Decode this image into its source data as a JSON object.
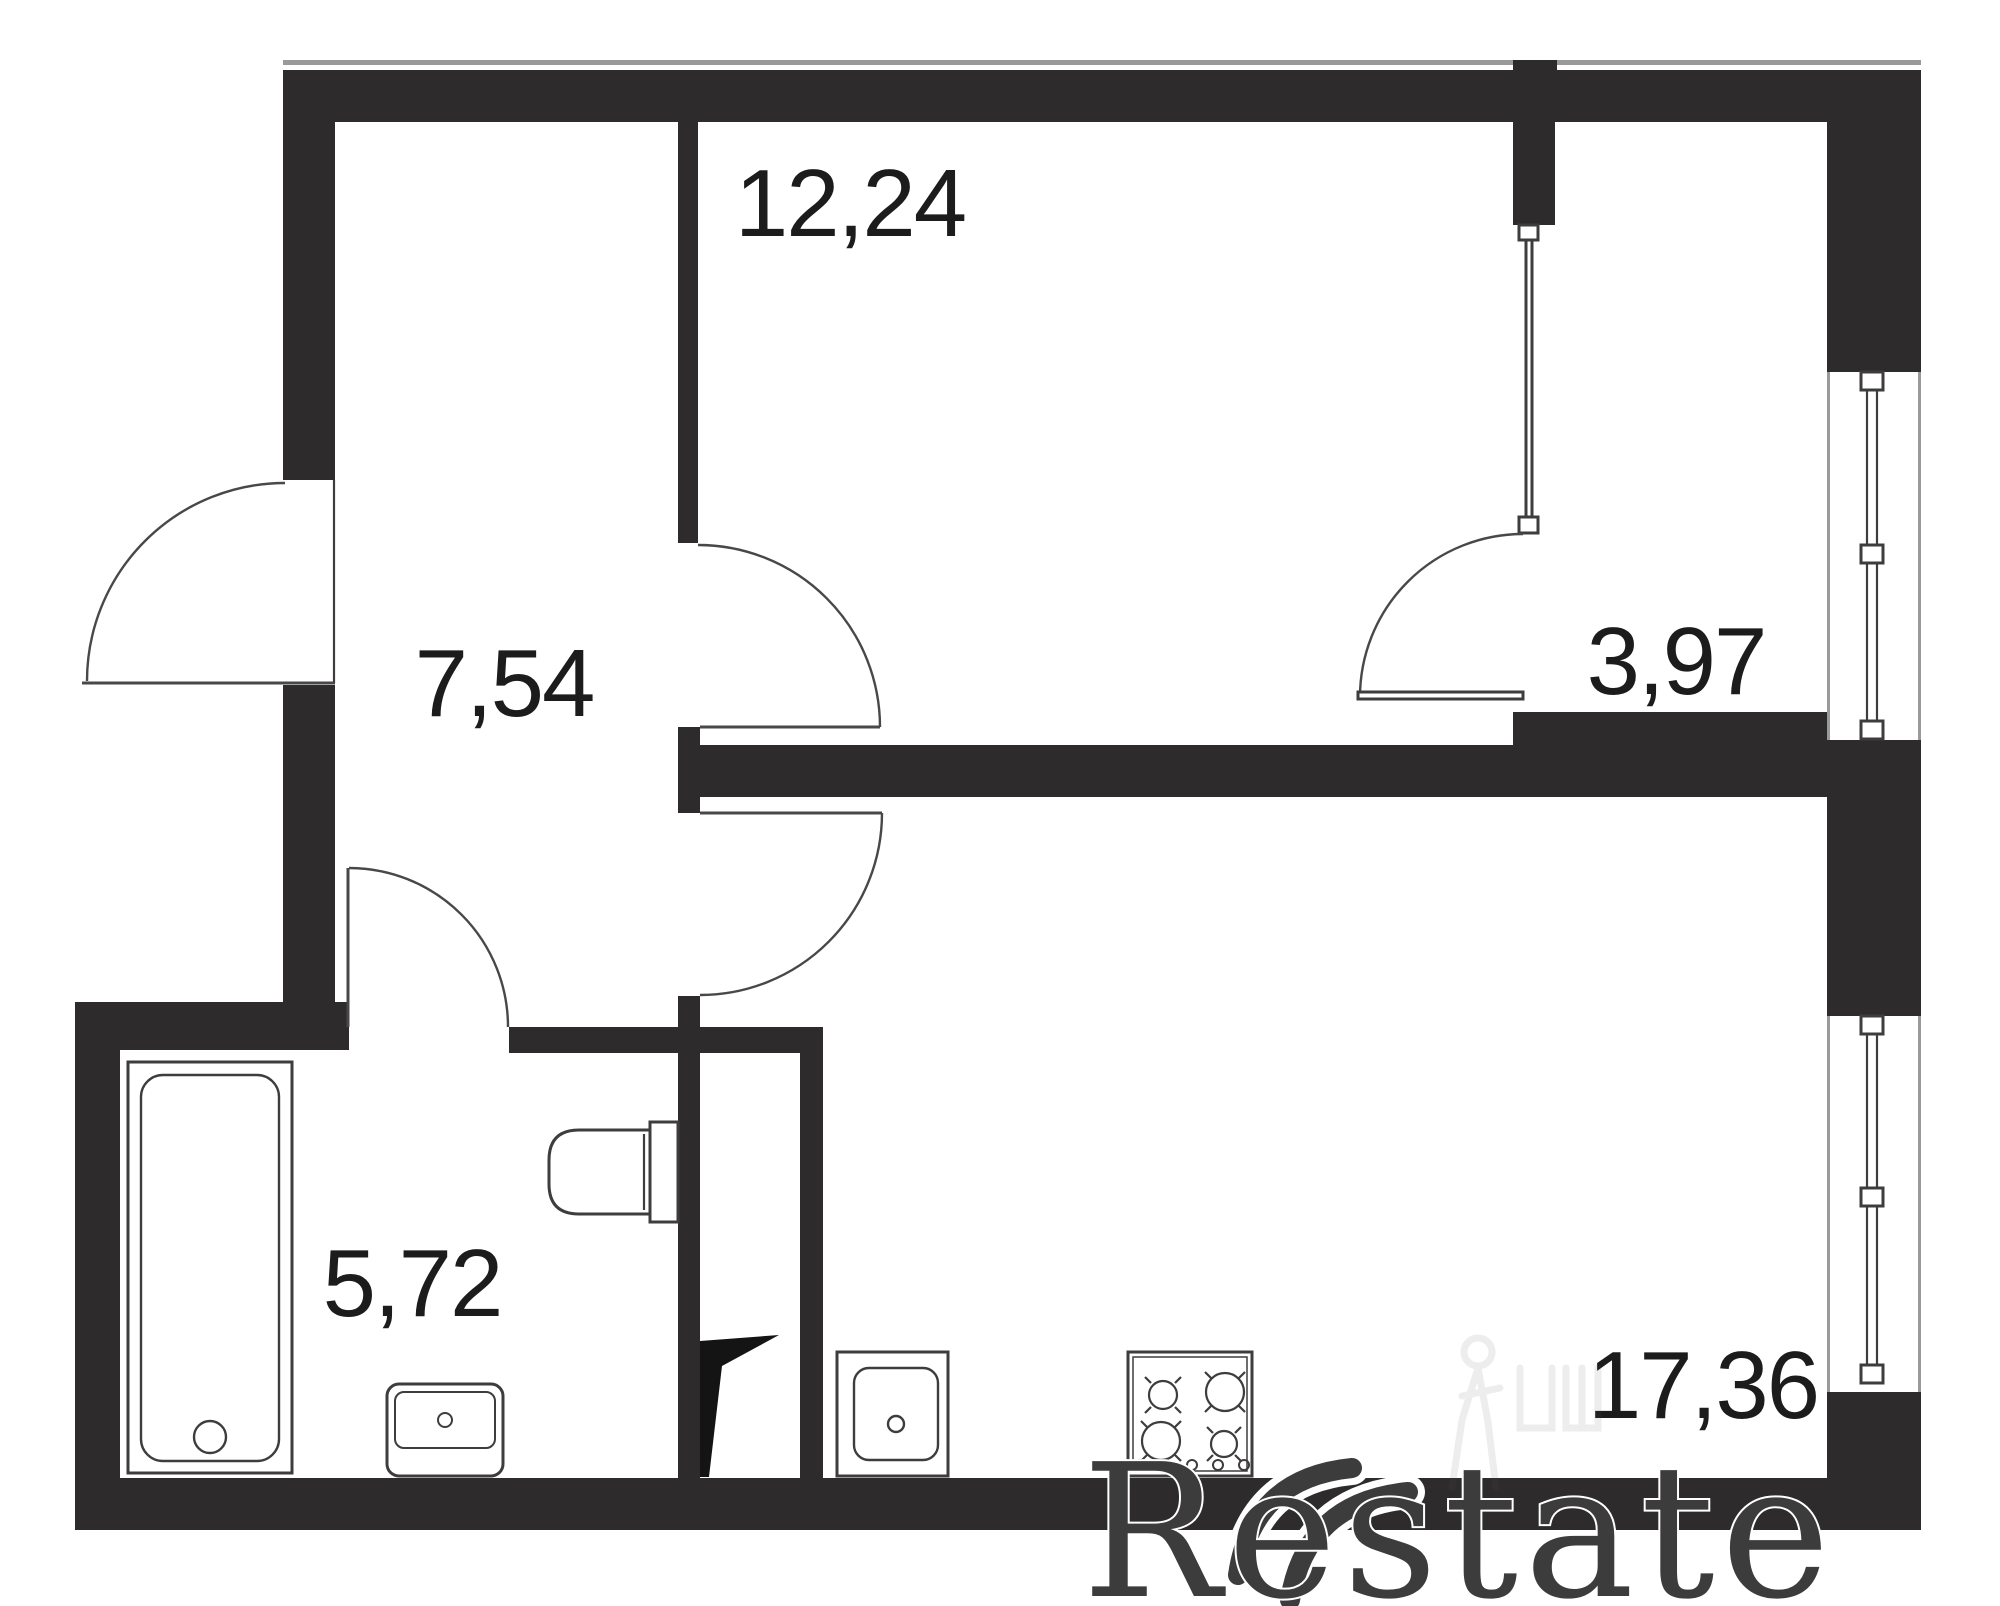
{
  "plan": {
    "title": "One-room apartment floor plan",
    "rooms": [
      {
        "name": "bedroom",
        "area": "12,24"
      },
      {
        "name": "hallway",
        "area": "7,54"
      },
      {
        "name": "balcony",
        "area": "3,97"
      },
      {
        "name": "bathroom",
        "area": "5,72"
      },
      {
        "name": "living-kitchen",
        "area": "17,36"
      }
    ],
    "doors": [
      "entrance-door",
      "bedroom-door",
      "kitchen-door",
      "bathroom-door",
      "balcony-door"
    ],
    "windows": [
      "upper-right-window",
      "lower-right-window"
    ],
    "fixtures": [
      "bathtub",
      "bathroom-sink",
      "toilet",
      "kitchen-sink",
      "stove-4-burner",
      "vent-shaft"
    ]
  },
  "watermark": {
    "brand": "Restate"
  },
  "colors": {
    "wall": "#2d2b2b",
    "line": "#3f3c3c",
    "label": "#1d1c1c",
    "hairline": "#9a9a9a",
    "watermark": "#3c3c3c"
  }
}
